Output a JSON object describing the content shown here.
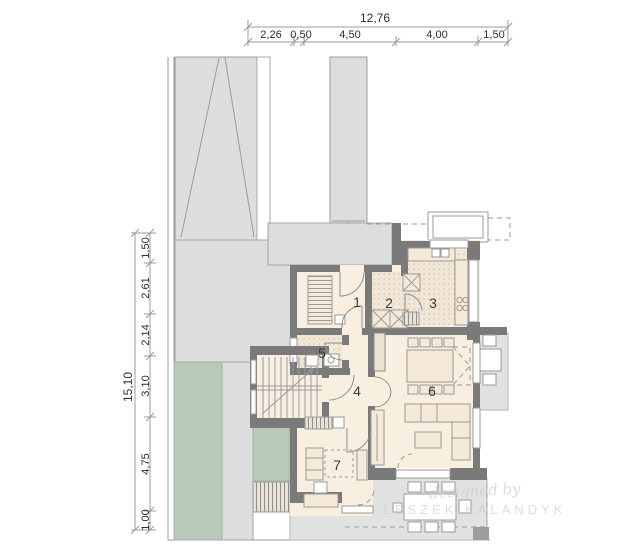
{
  "plan_title": "ground-floor-plan",
  "dimensions": {
    "top": {
      "total": "12,76",
      "segments": [
        "2,26",
        "0,50",
        "4,50",
        "4,00",
        "1,50"
      ]
    },
    "left": {
      "total": "15,10",
      "segments": [
        "1,50",
        "2,61",
        "2,14",
        "3,10",
        "4,75",
        "1,00"
      ]
    }
  },
  "rooms": [
    {
      "number": "1"
    },
    {
      "number": "2"
    },
    {
      "number": "3"
    },
    {
      "number": "4"
    },
    {
      "number": "5"
    },
    {
      "number": "6"
    },
    {
      "number": "7"
    }
  ],
  "watermark": {
    "line1": "designed by",
    "line2": "LESZEK KALANDYK"
  },
  "colors": {
    "wall": "#7a7a7a",
    "floor": "#f8efe0",
    "tile": "#f2e7d6",
    "paving": "#dcdedd",
    "lawn": "#b8c9ba",
    "terrace": "#e1e3e2"
  }
}
